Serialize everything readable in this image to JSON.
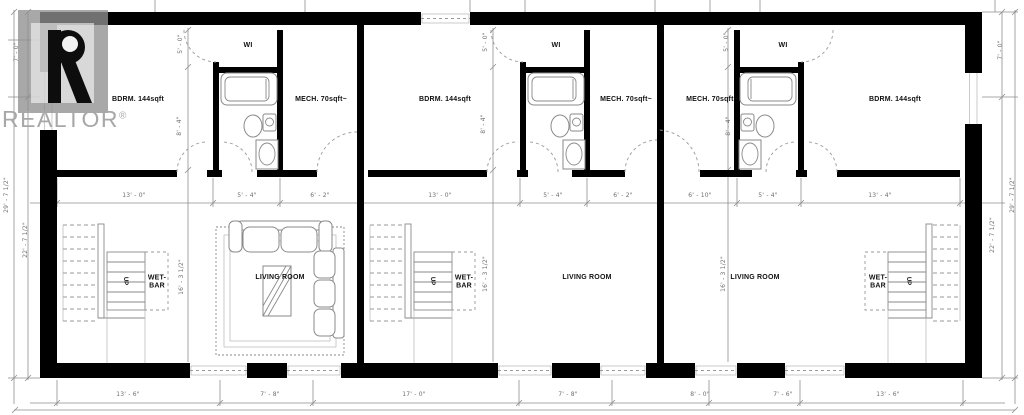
{
  "watermark": {
    "brand": "REALTOR",
    "reg": "®"
  },
  "colors": {
    "wall": "#000000",
    "line": "#8f8f8f",
    "fixture": "#8a8a8a",
    "dash": "#9a9a9a",
    "label": "#111111",
    "dim": "#6e6e6e",
    "watermark_gray": "#a8a8a8",
    "bg": "#ffffff"
  },
  "rooms": [
    {
      "name": "bedroom-1-label",
      "label": "BDRM. 144sqft",
      "x": 138,
      "y": 100
    },
    {
      "name": "bedroom-2-label",
      "label": "BDRM. 144sqft",
      "x": 445,
      "y": 100
    },
    {
      "name": "bedroom-3-label",
      "label": "BDRM. 144sqft",
      "x": 895,
      "y": 100
    },
    {
      "name": "walkin-closet-1-label",
      "label": "WI",
      "x": 248,
      "y": 46
    },
    {
      "name": "walkin-closet-2-label",
      "label": "WI",
      "x": 556,
      "y": 46
    },
    {
      "name": "walkin-closet-3-label",
      "label": "WI",
      "x": 783,
      "y": 46
    },
    {
      "name": "mech-room-1-label",
      "label": "MECH. 70sqft~",
      "x": 321,
      "y": 100
    },
    {
      "name": "mech-room-2-label",
      "label": "MECH. 70sqft~",
      "x": 626,
      "y": 100
    },
    {
      "name": "mech-room-3-label",
      "label": "MECH. 70sqft~",
      "x": 712,
      "y": 100
    },
    {
      "name": "living-room-1-label",
      "label": "LIVING ROOM",
      "x": 280,
      "y": 278
    },
    {
      "name": "living-room-2-label",
      "label": "LIVING ROOM",
      "x": 587,
      "y": 278
    },
    {
      "name": "living-room-3-label",
      "label": "LIVING ROOM",
      "x": 755,
      "y": 278
    },
    {
      "name": "wet-bar-1-label",
      "label": "WET-\nBAR",
      "x": 157,
      "y": 283
    },
    {
      "name": "wet-bar-2-label",
      "label": "WET-\nBAR",
      "x": 464,
      "y": 283
    },
    {
      "name": "wet-bar-3-label",
      "label": "WET-\nBAR",
      "x": 878,
      "y": 283
    },
    {
      "name": "stairs-up-1-label",
      "label": "UP",
      "x": 125,
      "y": 281,
      "up": true
    },
    {
      "name": "stairs-up-2-label",
      "label": "UP",
      "x": 432,
      "y": 281,
      "up": true
    },
    {
      "name": "stairs-up-3-label",
      "label": "UP",
      "x": 908,
      "y": 281,
      "up": true
    }
  ],
  "dimensions": [
    {
      "label": "13' - 0\"",
      "x": 134,
      "y": 196
    },
    {
      "label": "5' - 4\"",
      "x": 247,
      "y": 196
    },
    {
      "label": "6' - 2\"",
      "x": 320,
      "y": 196
    },
    {
      "label": "13' - 0\"",
      "x": 440,
      "y": 196
    },
    {
      "label": "5' - 4\"",
      "x": 553,
      "y": 196
    },
    {
      "label": "6' - 2\"",
      "x": 623,
      "y": 196
    },
    {
      "label": "6' - 10\"",
      "x": 700,
      "y": 196
    },
    {
      "label": "5' - 4\"",
      "x": 768,
      "y": 196
    },
    {
      "label": "13' - 4\"",
      "x": 880,
      "y": 196
    },
    {
      "label": "13' - 6\"",
      "x": 128,
      "y": 395
    },
    {
      "label": "7' - 8\"",
      "x": 270,
      "y": 395
    },
    {
      "label": "17' - 0\"",
      "x": 414,
      "y": 395
    },
    {
      "label": "7' - 8\"",
      "x": 568,
      "y": 395
    },
    {
      "label": "8' - 0\"",
      "x": 700,
      "y": 395
    },
    {
      "label": "7' - 6\"",
      "x": 783,
      "y": 395
    },
    {
      "label": "13' - 6\"",
      "x": 888,
      "y": 395
    },
    {
      "label": "7' - 0\"",
      "x": 17,
      "y": 52,
      "rot": true
    },
    {
      "label": "29' - 7 1/2\"",
      "x": 7,
      "y": 195,
      "rot": true
    },
    {
      "label": "22' - 7 1/2\"",
      "x": 26,
      "y": 240,
      "rot": true
    },
    {
      "label": "7' - 0\"",
      "x": 1001,
      "y": 50,
      "rot": true
    },
    {
      "label": "22' - 7 1/2\"",
      "x": 993,
      "y": 235,
      "rot": true
    },
    {
      "label": "29' - 7 1/2\"",
      "x": 1013,
      "y": 195,
      "rot": true
    },
    {
      "label": "5' - 0\"",
      "x": 181,
      "y": 44,
      "rot": true
    },
    {
      "label": "5' - 0\"",
      "x": 486,
      "y": 42,
      "rot": true
    },
    {
      "label": "5' - 0\"",
      "x": 727,
      "y": 42,
      "rot": true
    },
    {
      "label": "8' - 4\"",
      "x": 180,
      "y": 126,
      "rot": true
    },
    {
      "label": "8' - 4\"",
      "x": 484,
      "y": 124,
      "rot": true
    },
    {
      "label": "8' - 4\"",
      "x": 729,
      "y": 126,
      "rot": true
    },
    {
      "label": "16' - 3 1/2\"",
      "x": 182,
      "y": 277,
      "rot": true
    },
    {
      "label": "16' - 3 1/2\"",
      "x": 486,
      "y": 274,
      "rot": true
    },
    {
      "label": "16' - 3 1/2\"",
      "x": 724,
      "y": 274,
      "rot": true
    }
  ]
}
